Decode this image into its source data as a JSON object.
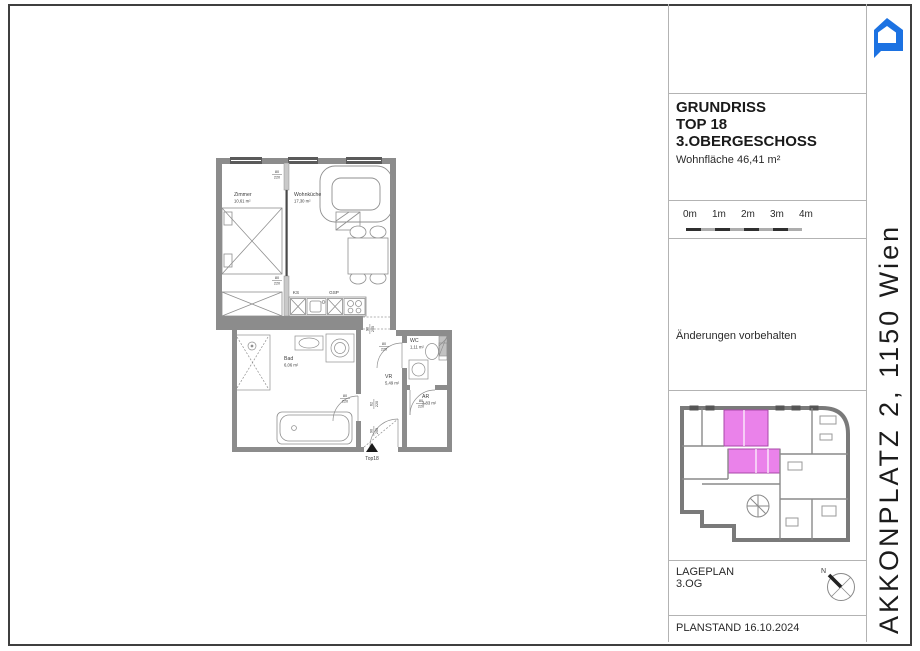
{
  "page": {
    "background": "#ffffff",
    "frame_color": "#3f3f3f"
  },
  "logo": {
    "name": "house-chat-logo",
    "color": "#1c72e2"
  },
  "side_label": {
    "text": "AKKONPLATZ 2, 1150 Wien"
  },
  "title_block": {
    "line1": "GRUNDRISS",
    "line2": "TOP 18",
    "line3": "3.OBERGESCHOSS",
    "area_label": "Wohnfläche 46,41 m²"
  },
  "scale_bar": {
    "ticks": [
      "0m",
      "1m",
      "2m",
      "3m",
      "4m"
    ]
  },
  "notes": {
    "text": "Änderungen vorbehalten"
  },
  "site_plan": {
    "highlight_color": "#ea82ea",
    "caption_line1": "LAGEPLAN",
    "caption_line2": "3.OG",
    "north_label": "N"
  },
  "plan_status": {
    "text": "PLANSTAND 16.10.2024"
  },
  "floor_plan": {
    "rooms": [
      {
        "name": "Zimmer",
        "area": "10,61 m²"
      },
      {
        "name": "Wohnküche",
        "area": "17,30 m²"
      },
      {
        "name": "Bad",
        "area": "6,06 m²"
      },
      {
        "name": "VR",
        "area": "5,49 m²"
      },
      {
        "name": "WC",
        "area": "1,11 m²"
      },
      {
        "name": "AR",
        "area": "3,83 m²"
      }
    ],
    "kitchen_labels": {
      "ks": "KS",
      "gsp": "GSP"
    },
    "door_labels": {
      "standard": {
        "w": "80",
        "h": "220"
      },
      "entrance": {
        "w": "62",
        "h": "220"
      },
      "passage": {
        "w": "90",
        "h": "205"
      }
    },
    "entrance_label": "Top18"
  }
}
